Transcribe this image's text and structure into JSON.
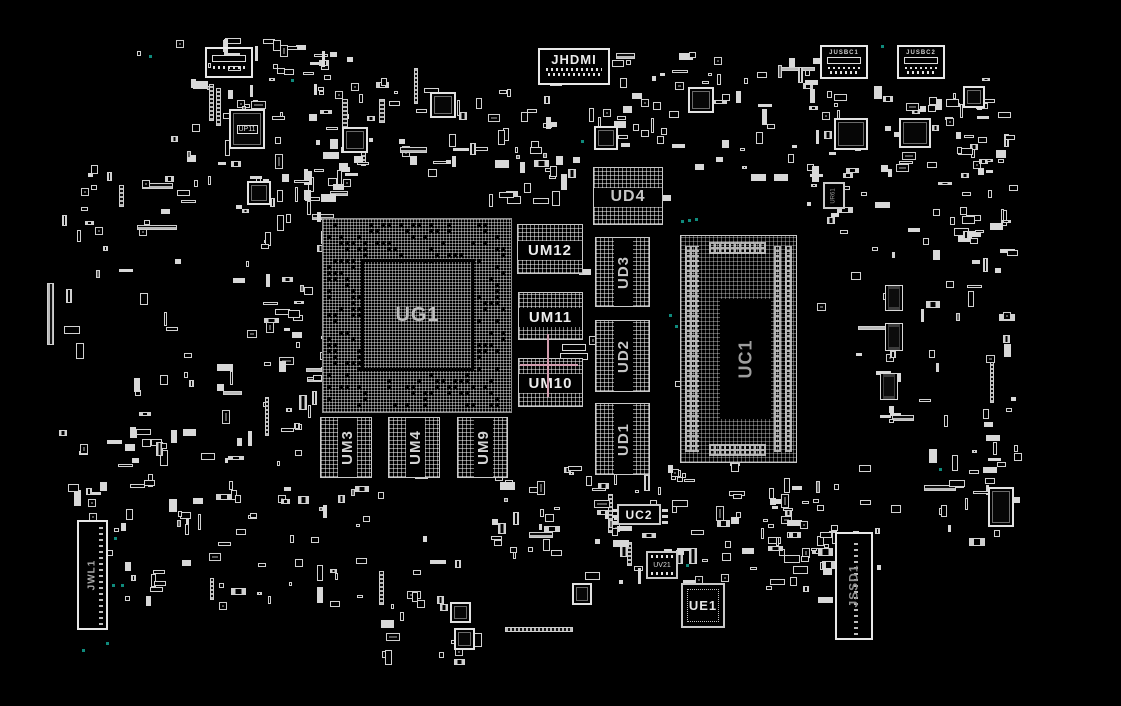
{
  "app": {
    "name": "pcb-boardview",
    "background": "#000000"
  },
  "board": {
    "width": 1121,
    "height": 706,
    "components": [
      {
        "label": "JHDMI",
        "kind": "conn",
        "dir": "h",
        "x": 538,
        "y": 48,
        "w": 72,
        "h": 37,
        "fs": 13,
        "color": "#ececec"
      },
      {
        "label": "UD4",
        "kind": "dram",
        "band": "h",
        "x": 593,
        "y": 167,
        "w": 70,
        "h": 58,
        "fs": 16,
        "color": "#c6c6c6"
      },
      {
        "label": "UM12",
        "kind": "dram",
        "band": "h",
        "x": 517,
        "y": 224,
        "w": 66,
        "h": 50,
        "fs": 15,
        "color": "#ededed"
      },
      {
        "label": "UD3",
        "kind": "dram",
        "band": "v",
        "x": 595,
        "y": 237,
        "w": 55,
        "h": 70,
        "fs": 15,
        "color": "#c6c6c6"
      },
      {
        "label": "UM11",
        "kind": "dram",
        "band": "h",
        "x": 518,
        "y": 292,
        "w": 65,
        "h": 48,
        "fs": 15,
        "color": "#ededed"
      },
      {
        "label": "UD2",
        "kind": "dram",
        "band": "v",
        "x": 595,
        "y": 320,
        "w": 55,
        "h": 72,
        "fs": 15,
        "color": "#c6c6c6"
      },
      {
        "label": "UM10",
        "kind": "dram",
        "band": "h",
        "x": 518,
        "y": 358,
        "w": 65,
        "h": 49,
        "fs": 15,
        "color": "#ededed"
      },
      {
        "label": "UD1",
        "kind": "dram",
        "band": "v",
        "x": 595,
        "y": 403,
        "w": 55,
        "h": 72,
        "fs": 15,
        "color": "#c6c6c6"
      },
      {
        "label": "UG1",
        "kind": "bga",
        "x": 322,
        "y": 218,
        "w": 190,
        "h": 195,
        "die": {
          "x": 38,
          "y": 40,
          "w": 113,
          "h": 112
        },
        "fs": 20,
        "color": "#bdbdbd"
      },
      {
        "label": "UC1",
        "kind": "soc",
        "x": 680,
        "y": 235,
        "w": 117,
        "h": 228,
        "die": {
          "x": 39,
          "y": 63,
          "w": 51,
          "h": 120
        },
        "fs": 18,
        "color": "#9e9e9e"
      },
      {
        "label": "UM3",
        "kind": "dram",
        "band": "v",
        "x": 320,
        "y": 417,
        "w": 52,
        "h": 61,
        "fs": 15,
        "color": "#d5d5d5"
      },
      {
        "label": "UM4",
        "kind": "dram",
        "band": "v",
        "x": 388,
        "y": 417,
        "w": 52,
        "h": 61,
        "fs": 15,
        "color": "#d5d5d5"
      },
      {
        "label": "UM9",
        "kind": "dram",
        "band": "v",
        "x": 457,
        "y": 417,
        "w": 51,
        "h": 61,
        "fs": 15,
        "color": "#d5d5d5"
      },
      {
        "label": "UC2",
        "kind": "chip",
        "x": 617,
        "y": 504,
        "w": 44,
        "h": 21,
        "fs": 12,
        "color": "#ededed",
        "pins": 3
      },
      {
        "label": "UV21",
        "kind": "chip",
        "x": 646,
        "y": 551,
        "w": 32,
        "h": 28,
        "fs": 7,
        "color": "#d8d8d8",
        "padsTB": true
      },
      {
        "label": "UE1",
        "kind": "chip",
        "x": 681,
        "y": 583,
        "w": 44,
        "h": 45,
        "fs": 13,
        "color": "#e6e6e6",
        "ring": true
      },
      {
        "label": "JSSD1",
        "kind": "conn",
        "dir": "v",
        "x": 835,
        "y": 532,
        "w": 38,
        "h": 108,
        "fs": 12,
        "color": "#8f8f8f",
        "dots": "center"
      },
      {
        "label": "JWL1",
        "kind": "conn",
        "dir": "v",
        "x": 77,
        "y": 520,
        "w": 31,
        "h": 110,
        "fs": 10,
        "color": "#aaaaaa",
        "dots": "right"
      },
      {
        "label": "UP11",
        "kind": "chip",
        "x": 229,
        "y": 109,
        "w": 36,
        "h": 40,
        "fs": 7,
        "color": "#e0e0e0",
        "boxed": true,
        "qfn": true
      },
      {
        "label": "JUSBC1",
        "kind": "conn",
        "dir": "h",
        "x": 820,
        "y": 45,
        "w": 48,
        "h": 34,
        "fs": 6,
        "color": "#d0d0d0",
        "slot": true
      },
      {
        "label": "JUSBC2",
        "kind": "conn",
        "dir": "h",
        "x": 897,
        "y": 45,
        "w": 48,
        "h": 34,
        "fs": 6,
        "color": "#d0d0d0",
        "slot": true
      },
      {
        "label": "UR61",
        "kind": "chip",
        "x": 823,
        "y": 182,
        "w": 22,
        "h": 27,
        "fs": 6,
        "color": "#9a9a9a",
        "vert": true
      }
    ],
    "fixtures": [
      [
        205,
        47,
        48,
        31,
        "conn"
      ],
      [
        342,
        127,
        26,
        26,
        "qfn"
      ],
      [
        430,
        92,
        26,
        26,
        "qfn"
      ],
      [
        688,
        87,
        26,
        26,
        "qfn"
      ],
      [
        594,
        126,
        24,
        24,
        "qfn"
      ],
      [
        963,
        86,
        22,
        22,
        "qfn"
      ],
      [
        834,
        118,
        34,
        32,
        "qfn"
      ],
      [
        899,
        118,
        32,
        30,
        "qfn"
      ],
      [
        247,
        181,
        24,
        24,
        "qfn"
      ],
      [
        450,
        602,
        21,
        21,
        "qfn"
      ],
      [
        454,
        628,
        21,
        22,
        "qfn"
      ],
      [
        572,
        583,
        20,
        22,
        "qfn"
      ],
      [
        885,
        285,
        18,
        26,
        "soic"
      ],
      [
        885,
        323,
        18,
        28,
        "soic"
      ],
      [
        880,
        373,
        18,
        27,
        "soic"
      ],
      [
        505,
        627,
        68,
        5,
        "bar"
      ],
      [
        47,
        283,
        7,
        62,
        "bar"
      ],
      [
        988,
        487,
        26,
        40,
        "qfn"
      ],
      [
        562,
        344,
        24,
        7,
        "tag"
      ],
      [
        560,
        353,
        28,
        7,
        "tag"
      ]
    ],
    "clusters": [
      [
        165,
        35,
        190,
        185,
        70
      ],
      [
        60,
        165,
        125,
        200,
        26
      ],
      [
        228,
        162,
        132,
        185,
        42
      ],
      [
        300,
        48,
        155,
        130,
        36
      ],
      [
        420,
        72,
        145,
        135,
        30
      ],
      [
        612,
        52,
        120,
        135,
        36
      ],
      [
        733,
        58,
        100,
        125,
        26
      ],
      [
        800,
        78,
        215,
        168,
        62
      ],
      [
        940,
        85,
        80,
        160,
        26
      ],
      [
        918,
        245,
        100,
        280,
        34
      ],
      [
        850,
        242,
        75,
        200,
        16
      ],
      [
        660,
        460,
        180,
        130,
        55
      ],
      [
        488,
        462,
        175,
        125,
        55
      ],
      [
        120,
        478,
        250,
        135,
        50
      ],
      [
        58,
        428,
        125,
        105,
        20
      ],
      [
        378,
        552,
        135,
        115,
        20
      ],
      [
        758,
        478,
        125,
        115,
        30
      ],
      [
        282,
        200,
        62,
        250,
        16
      ],
      [
        262,
        352,
        95,
        130,
        18
      ],
      [
        128,
        352,
        125,
        112,
        20
      ],
      [
        518,
        96,
        105,
        105,
        20
      ],
      [
        948,
        438,
        75,
        105,
        14
      ],
      [
        60,
        40,
        960,
        615,
        55
      ]
    ],
    "markers": {
      "color": "#0f8a7c",
      "size": 3,
      "points": [
        [
          150,
          56
        ],
        [
          292,
          80
        ],
        [
          582,
          141
        ],
        [
          682,
          221
        ],
        [
          689,
          220
        ],
        [
          696,
          219
        ],
        [
          882,
          46
        ],
        [
          670,
          315
        ],
        [
          676,
          326
        ],
        [
          115,
          538
        ],
        [
          113,
          585
        ],
        [
          122,
          585
        ],
        [
          107,
          643
        ],
        [
          83,
          650
        ],
        [
          940,
          469
        ],
        [
          687,
          565
        ]
      ]
    },
    "crosshair": {
      "color": "#d29cae",
      "cx": 548,
      "cy": 365,
      "x1": 520,
      "x2": 578,
      "y1": 334,
      "y2": 397,
      "thickness": 2
    }
  }
}
